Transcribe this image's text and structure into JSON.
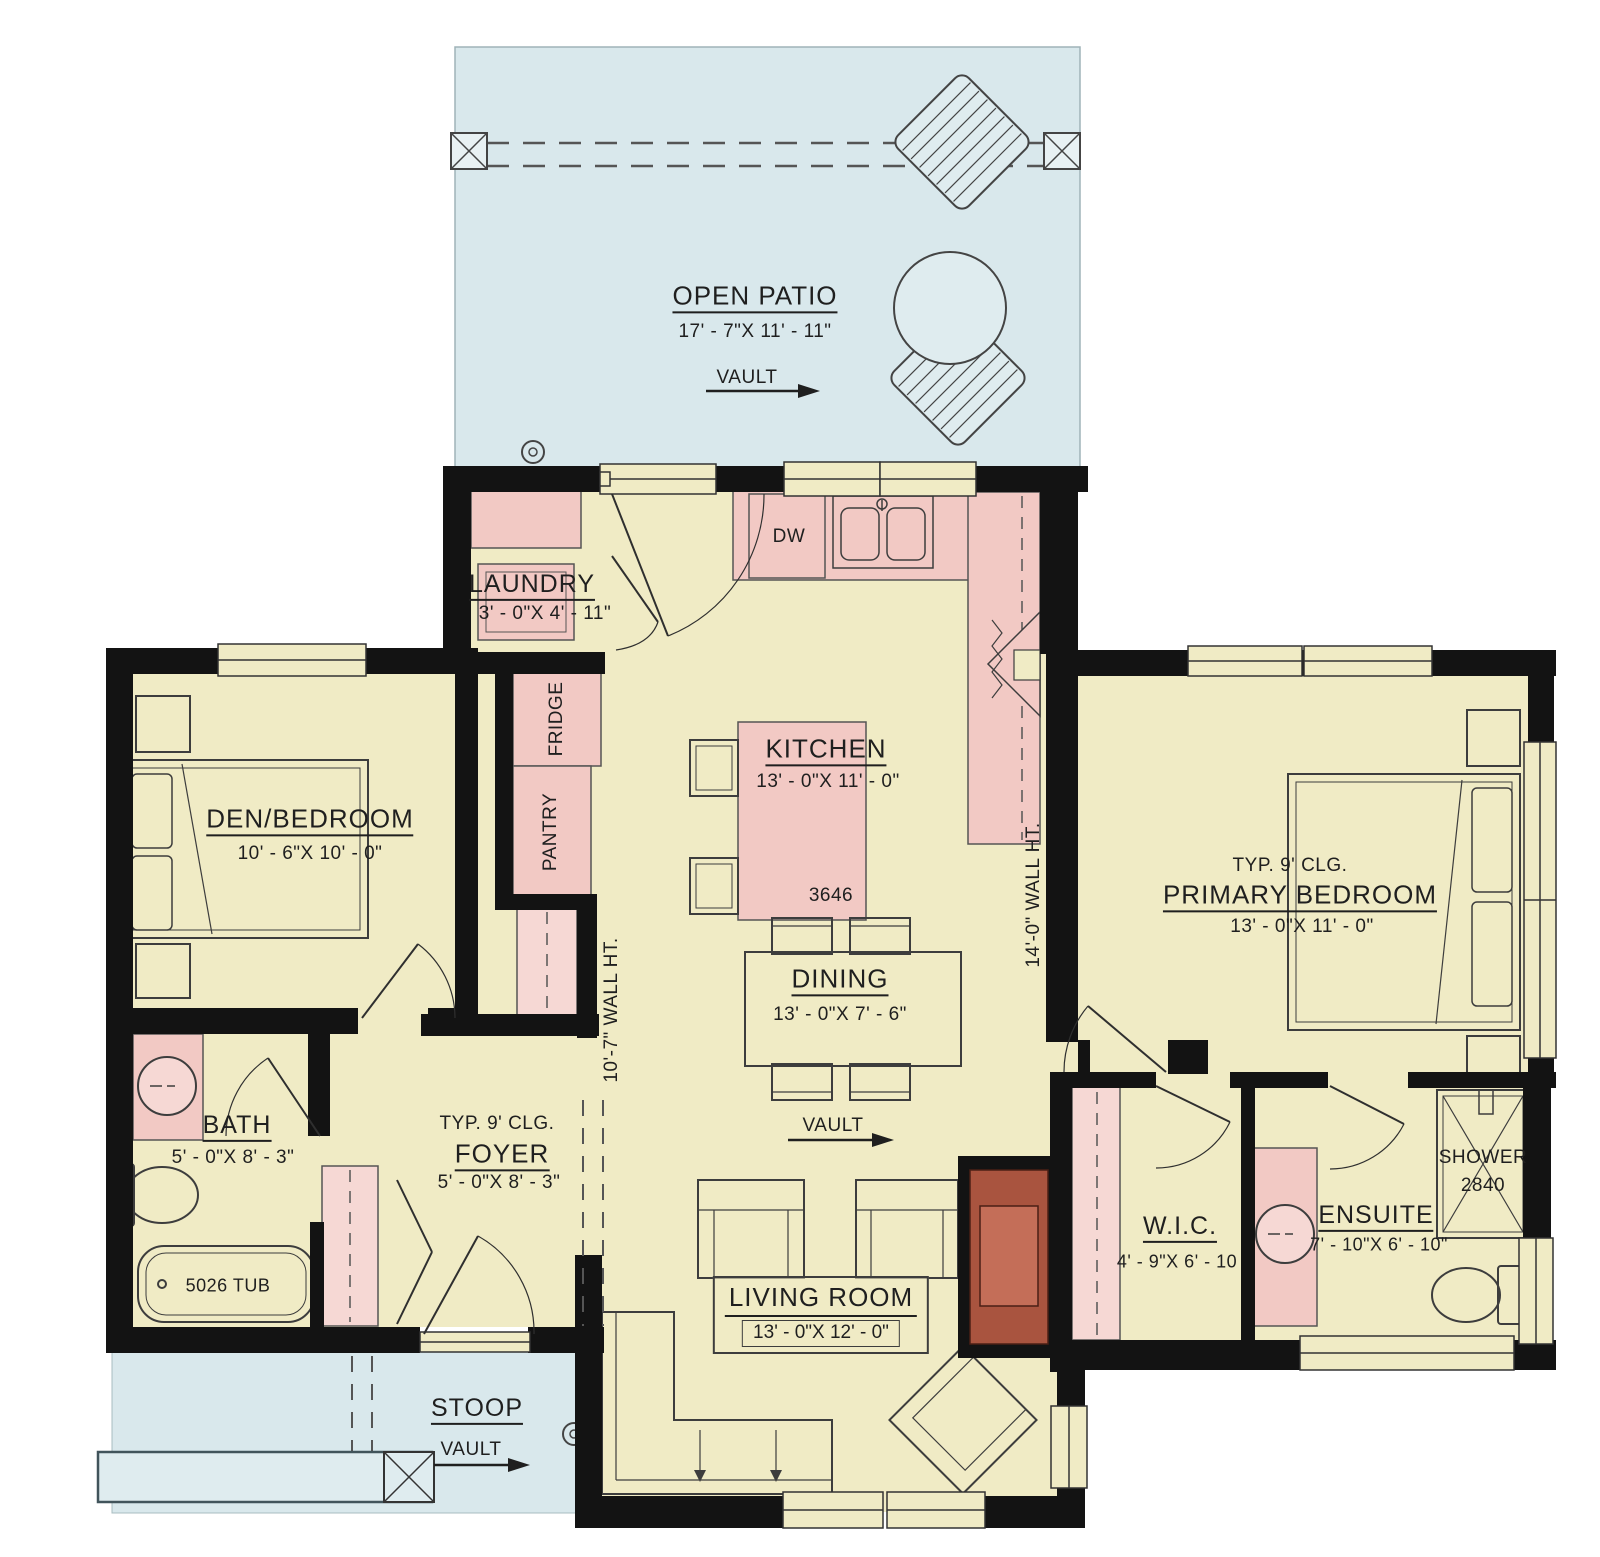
{
  "colors": {
    "floor": "#f0ebc5",
    "outdoor": "#d9e8ec",
    "cabinet_pink": "#f2c9c4",
    "closet_pink": "#f6d8d4",
    "fireplace": "#a9543f",
    "fireplace_inner": "#c46e58",
    "wall": "#131313",
    "line": "#3d3d3d"
  },
  "rooms": {
    "patio": {
      "name": "OPEN PATIO",
      "dims": "17' - 7\"X 11' - 11\"",
      "vault": "VAULT"
    },
    "laundry": {
      "name": "LAUNDRY",
      "dims": "3' - 0\"X 4' - 11\""
    },
    "kitchen": {
      "name": "KITCHEN",
      "dims": "13' - 0\"X 11' - 0\"",
      "island_size": "3646",
      "dw": "DW",
      "fridge": "FRIDGE",
      "pantry": "PANTRY"
    },
    "den": {
      "name": "DEN/BEDROOM",
      "dims": "10' - 6\"X 10' - 0\""
    },
    "primary": {
      "clg": "TYP. 9' CLG.",
      "name": "PRIMARY BEDROOM",
      "dims": "13' - 0\"X 11' - 0\""
    },
    "dining": {
      "name": "DINING",
      "dims": "13' - 0\"X 7' - 6\"",
      "vault": "VAULT"
    },
    "bath": {
      "name": "BATH",
      "dims": "5' - 0\"X 8' - 3\"",
      "tub": "5026 TUB"
    },
    "foyer": {
      "clg": "TYP. 9' CLG.",
      "name": "FOYER",
      "dims": "5' - 0\"X 8' - 3\""
    },
    "wic": {
      "name": "W.I.C.",
      "dims": "4' - 9\"X 6' - 10"
    },
    "ensuite": {
      "name": "ENSUITE",
      "dims": "7' - 10\"X 6' - 10\"",
      "shower_l1": "SHOWER",
      "shower_l2": "2840"
    },
    "living": {
      "name": "LIVING ROOM",
      "dims": "13' - 0\"X 12' - 0\""
    },
    "stoop": {
      "name": "STOOP",
      "vault": "VAULT"
    }
  },
  "annotations": {
    "wall_ht_left": "10'-7\" WALL HT.",
    "wall_ht_right": "14'-0\" WALL HT."
  }
}
